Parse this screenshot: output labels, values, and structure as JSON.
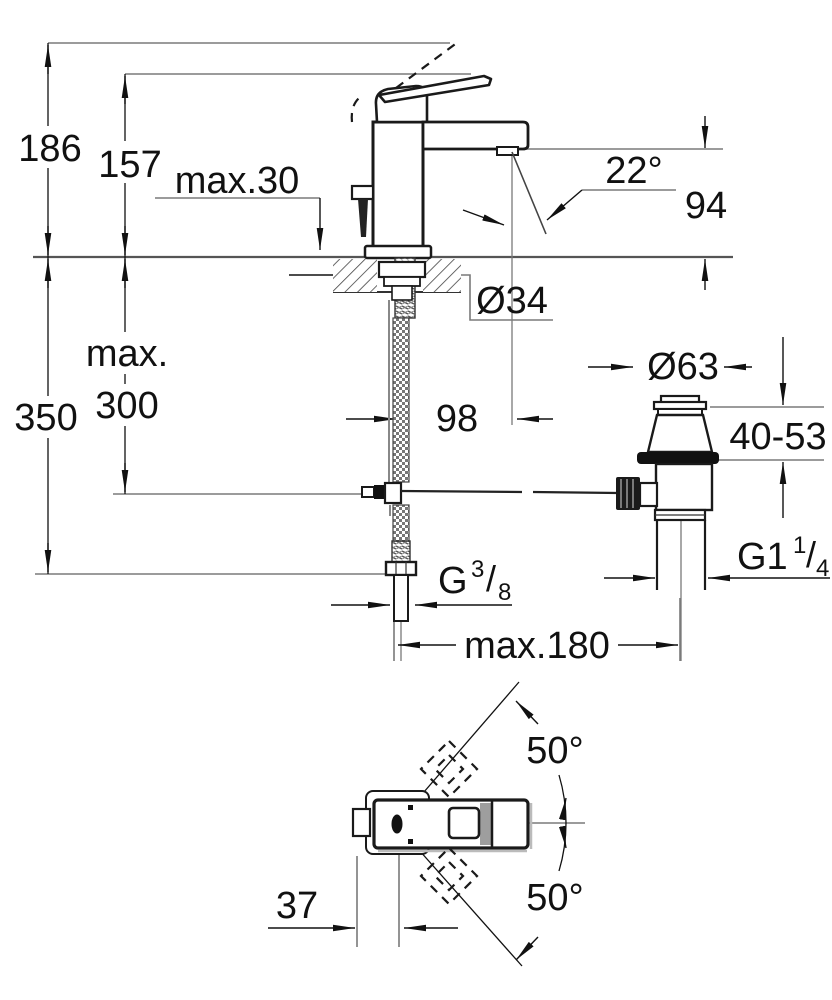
{
  "drawing": {
    "type": "faucet-installation-dimension-drawing",
    "views": [
      "front-elevation-with-deck-section",
      "pop-up-waste-assembly",
      "top-plan-view"
    ]
  },
  "labels": {
    "total_height": "186",
    "spout_top_height": "157",
    "deck_thickness_max": "max.30",
    "stream_angle": "22°",
    "outlet_height": "94",
    "depth_total": "350",
    "rod_depth_max_word": "max.",
    "rod_depth_max_value": "300",
    "hole_diameter": "Ø34",
    "projection": "98",
    "waste_flange_diameter": "Ø63",
    "clamping_range": "40-53",
    "reach_max": "max.180",
    "swivel_upper": "50°",
    "swivel_lower": "50°",
    "handle_offset": "37",
    "supply_thread": {
      "g": "G",
      "sup": "3",
      "slash": "/",
      "sub": "8"
    },
    "waste_thread": {
      "g": "G1",
      "sup": "1",
      "slash": "/",
      "sub": "4"
    }
  },
  "colors": {
    "object_line": "#1a1a1a",
    "dimension_line": "#111111",
    "reference_line": "#7a7a7a",
    "deck_line": "#555555",
    "background": "#ffffff",
    "handle_grip_gray": "#9e9e9e"
  }
}
